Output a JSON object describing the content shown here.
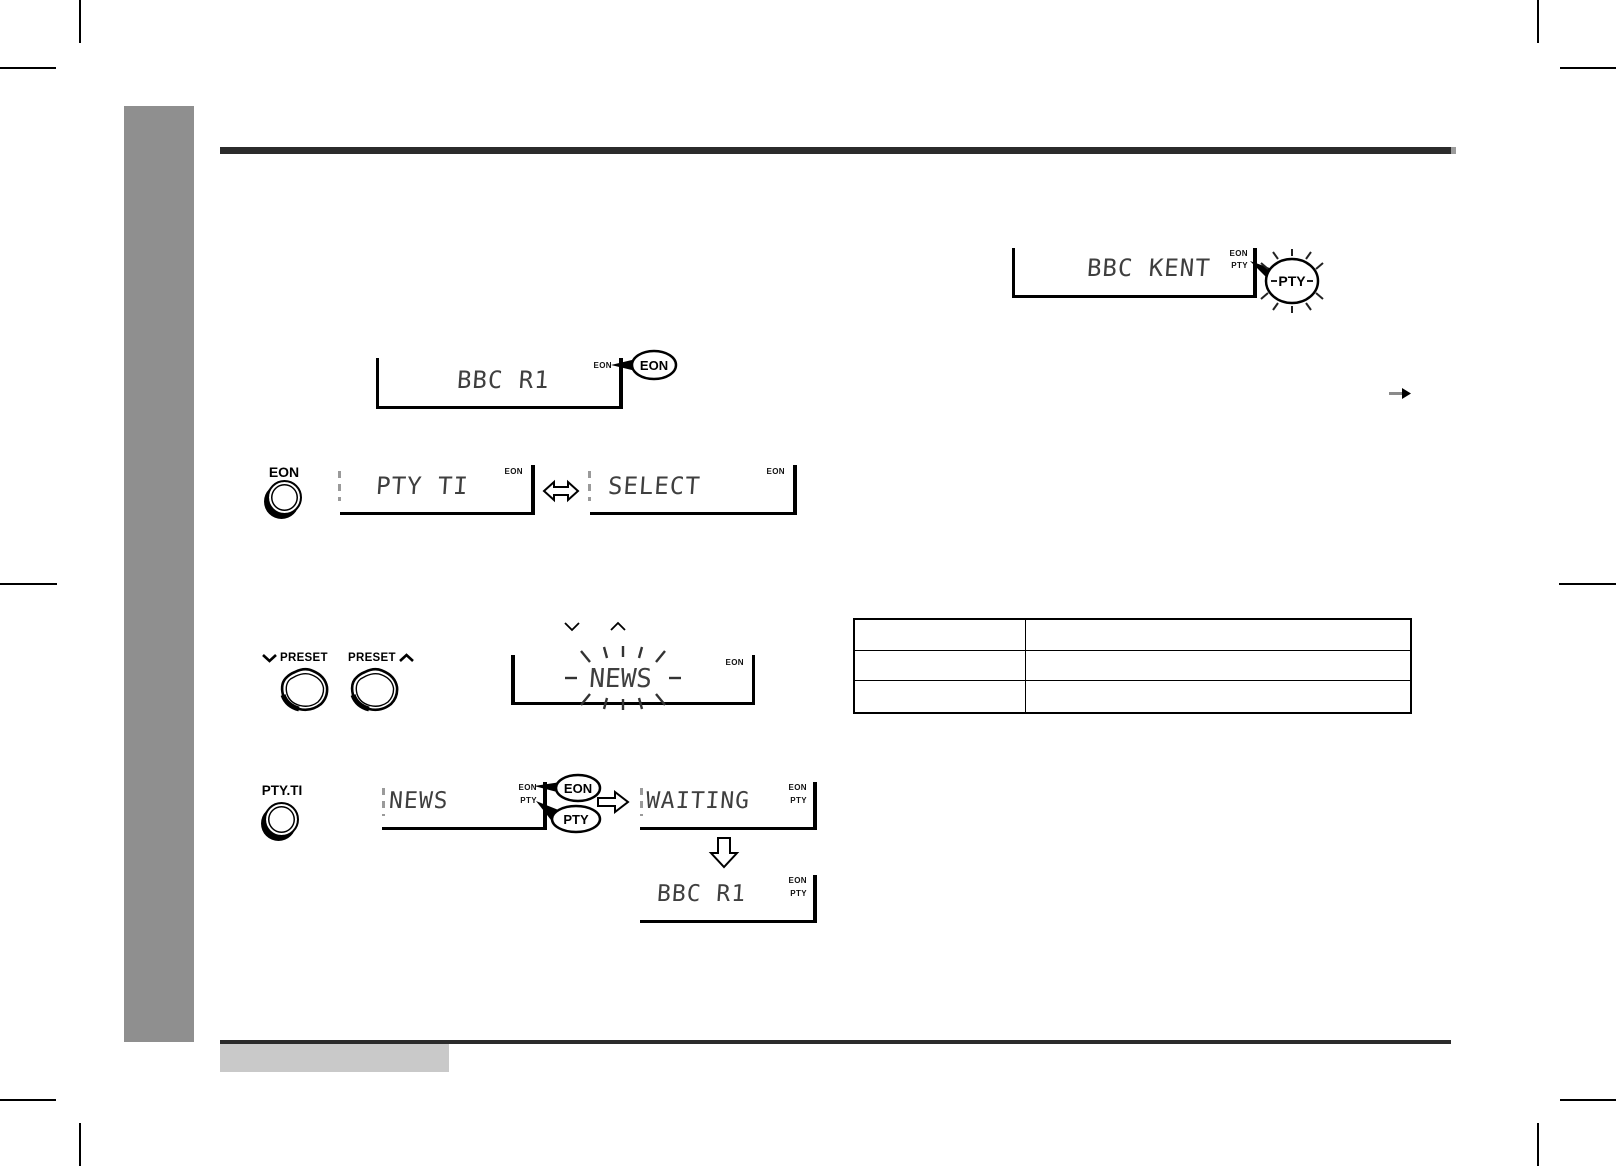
{
  "document": {
    "type": "audio-system instruction manual page",
    "section": "EON / PTY radio data system figures"
  },
  "displays": {
    "bbc_kent": {
      "text": "BBC KENT",
      "ind_eon": "EON",
      "ind_pty": "PTY"
    },
    "bbc_r1_top": {
      "text": "BBC R1",
      "ind_eon": "EON"
    },
    "pty_ti": {
      "text": "PTY TI",
      "ind_eon": "EON"
    },
    "select": {
      "text": "SELECT",
      "ind_eon": "EON"
    },
    "news_flash": {
      "text": "NEWS",
      "ind_eon": "EON"
    },
    "news": {
      "text": "NEWS",
      "ind_eon": "EON",
      "ind_pty": "PTY"
    },
    "waiting": {
      "text": "WAITING",
      "ind_eon": "EON",
      "ind_pty": "PTY"
    },
    "bbc_r1_bottom": {
      "text": "BBC R1",
      "ind_eon": "EON",
      "ind_pty": "PTY"
    }
  },
  "balloons": {
    "pty_flash": "PTY",
    "eon_top": "EON",
    "eon_row4": "EON",
    "pty_row4": "PTY"
  },
  "buttons": {
    "eon": "EON",
    "pty_ti": "PTY.TI",
    "preset_down": "PRESET",
    "preset_up": "PRESET"
  },
  "icons": {
    "goto_arrow": "→",
    "double_arrow": "⇔",
    "next_arrow": "⇨",
    "down_arrow": "⇩",
    "chevron_down": "∨",
    "chevron_up": "∧"
  },
  "table": {
    "rows": [
      [
        "",
        ""
      ],
      [
        "",
        ""
      ],
      [
        "",
        ""
      ]
    ]
  },
  "colors": {
    "sidebar": "#8f8f8f",
    "rule": "#2b2b2b",
    "footer_box": "#c9c9c9",
    "lcd_text": "#3f3f3f"
  }
}
